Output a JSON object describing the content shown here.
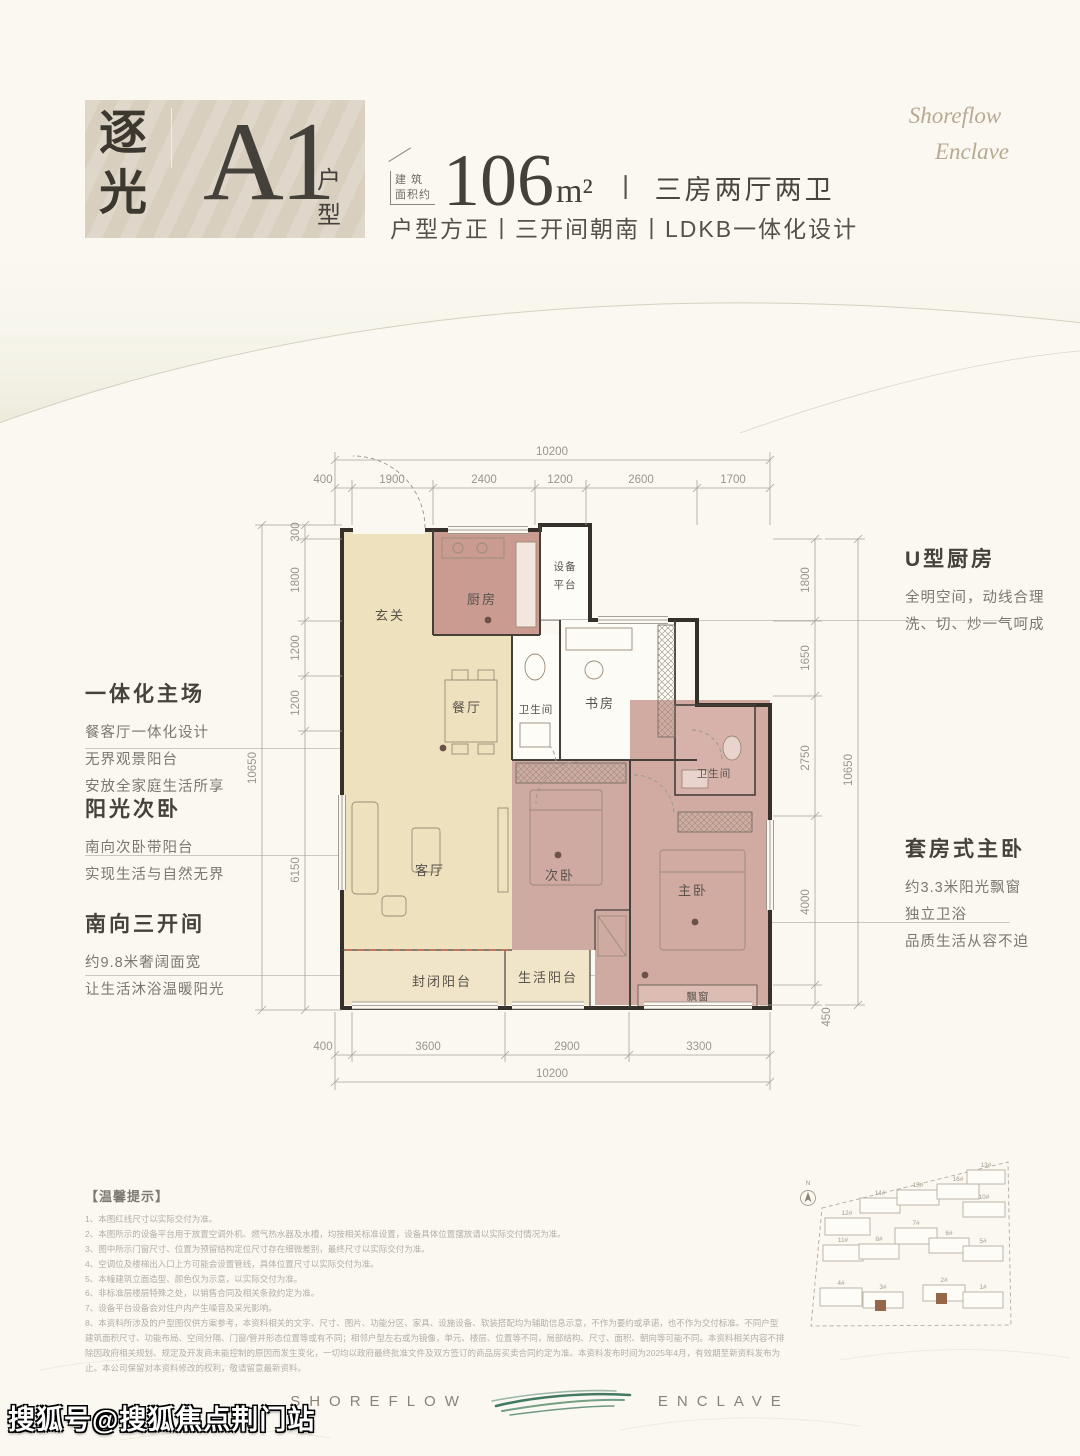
{
  "header": {
    "logo_char1": "逐",
    "logo_char2": "光",
    "unit_code": "A1",
    "unit_label": "户型",
    "area_prefix_line1": "建 筑",
    "area_prefix_line2": "面积约",
    "area_value": "106",
    "area_unit": "m²",
    "divider": "丨",
    "layout_spec": "三房两厅两卫",
    "tagline": "户型方正丨三开间朝南丨LDKB一体化设计",
    "brand_line1": "Shoreflow",
    "brand_line2": "Enclave"
  },
  "floorplan": {
    "rooms": {
      "entry": "玄关",
      "kitchen": "厨房",
      "equipment_line1": "设备",
      "equipment_line2": "平台",
      "dining": "餐厅",
      "bath1": "卫生间",
      "study": "书房",
      "bath2": "卫生间",
      "living": "客厅",
      "bedroom2": "次卧",
      "master": "主卧",
      "balcony_enclosed": "封闭阳台",
      "balcony_life": "生活阳台",
      "bay_window": "飘窗"
    },
    "dims_top": {
      "overall": "10200",
      "segments": [
        "400",
        "1900",
        "2400",
        "1200",
        "2600",
        "1700"
      ]
    },
    "dims_bottom": {
      "overall": "10200",
      "segments": [
        "400",
        "3600",
        "2900",
        "3300"
      ]
    },
    "dims_left": {
      "overall": "10650",
      "segments": [
        "300",
        "1800",
        "1200",
        "1200",
        "6150"
      ]
    },
    "dims_right": {
      "overall": "10650",
      "segments": [
        "1800",
        "1650",
        "2750",
        "4000",
        "450"
      ]
    }
  },
  "annotations": {
    "left": [
      {
        "title": "一体化主场",
        "lines": [
          "餐客厅一体化设计",
          "无界观景阳台",
          "安放全家庭生活所享"
        ]
      },
      {
        "title": "阳光次卧",
        "lines": [
          "南向次卧带阳台",
          "实现生活与自然无界"
        ]
      },
      {
        "title": "南向三开间",
        "lines": [
          "约9.8米奢阔面宽",
          "让生活沐浴温暖阳光"
        ]
      }
    ],
    "right": [
      {
        "title": "U型厨房",
        "lines": [
          "全明空间，动线合理",
          "洗、切、炒一气呵成"
        ]
      },
      {
        "title": "套房式主卧",
        "lines": [
          "约3.3米阳光飘窗",
          "独立卫浴",
          "品质生活从容不迫"
        ]
      }
    ]
  },
  "disclaimer": {
    "title": "【温馨提示】",
    "items": [
      "1、本图红线尺寸以实际交付为准。",
      "2、本图所示的设备平台用于放置空调外机、燃气热水器及水槽，均按相关标准设置，设备具体位置摆放请以实际交付情况为准。",
      "3、图中所示门窗尺寸、位置为预留结构定位尺寸存在细微差别，最终尺寸以实际交付为准。",
      "4、空调位及楼梯出入口上方可能会设置管线，具体位置尺寸以实际交付为准。",
      "5、本幢建筑立面造型、颜色仅为示意，以实际交付为准。",
      "6、非标准层楼层特殊之处，以销售合同及相关条款约定为准。",
      "7、设备平台设备会对住户内产生噪音及采光影响。",
      "8、本资料所涉及的户型图仅供方案参考，本资料相关的文字、尺寸、图片、功能分区、家具、设施设备、软装搭配均为辅助信息示意，不作为要约或承诺，也不作为交付标准。不同户型建筑面积尺寸、功能布局、空间分隔、门窗/管井形态位置等或有不同；相邻户型左右或为镜像，单元、楼层、位置等不同，局部结构、尺寸、面积、朝向等可能不同。本资料相关内容不排除因政府相关规划、规定及开发商未能控制的原因而发生变化，一切均以政府最终批准文件及双方签订的商品房买卖合同约定为准。本资料发布时间为2025年4月，有效期至新资料发布为止。本公司保留对本资料修改的权利，敬请留意最新资料。"
    ]
  },
  "siteplan": {
    "north": "N",
    "buildings": [
      "12#",
      "14#",
      "15#",
      "16#",
      "13#",
      "10#",
      "11#",
      "8#",
      "7#",
      "6#",
      "5#",
      "4#",
      "3#",
      "2#",
      "1#"
    ]
  },
  "footer": {
    "brand_left": "SHOREFLOW",
    "brand_right": "ENCLAVE"
  },
  "watermark": {
    "text": "搜狐号@搜狐焦点荆门站"
  }
}
